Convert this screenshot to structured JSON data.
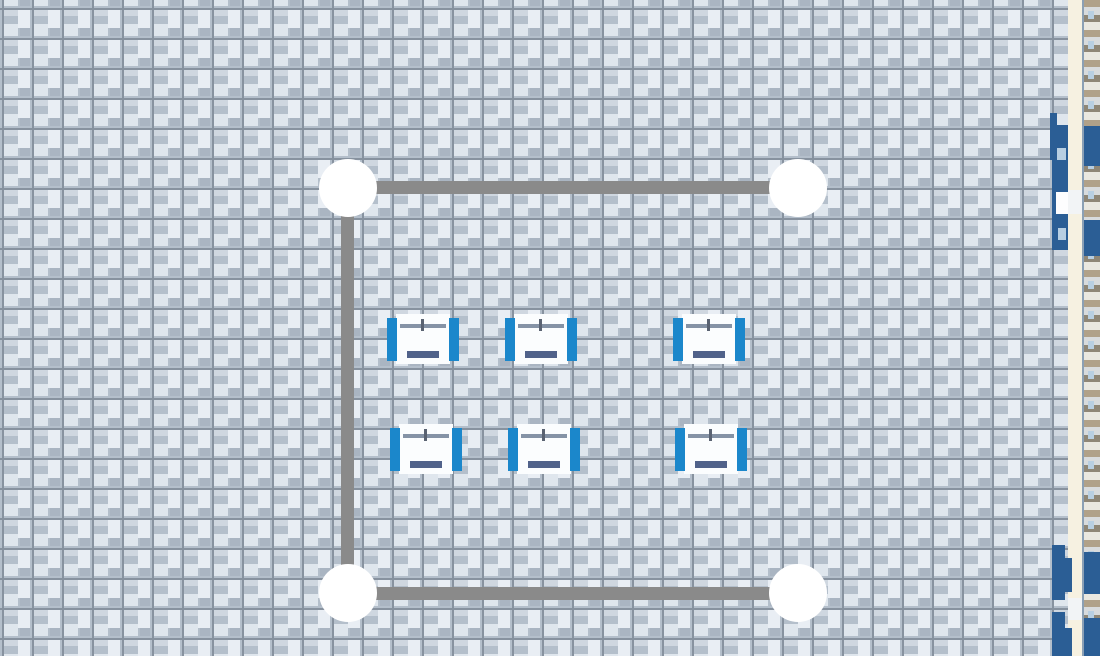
{
  "scene": {
    "width": 1100,
    "height": 656,
    "description": "top-down construction-game floor view with fence path, posts and gym benches"
  },
  "palette": {
    "paver_base": "#b4bfcb",
    "paver_light": "#e9eef4",
    "paver_soft": "#dfe6ed",
    "paver_mid": "#cfd7e0",
    "paver_dark": "#aab5c2",
    "grout": "#87929f",
    "path_gray": "#8a8a8a",
    "node_white": "#ffffff",
    "bench_blue": "#1b87cb",
    "bench_body": "#fbfdfe",
    "barbell_gray": "#8593a6",
    "barbell_dark": "#5a6372",
    "pad_slate": "#50628a",
    "steel_blue": "#2b5e95",
    "cream": "#f6f1e1",
    "edge_line": "#8ba0b5",
    "door_light": "#f2f4f6",
    "light_blue_sq": "#b8cfe2",
    "white": "#fdfdfe",
    "plank_tan": "#b0a189",
    "plank_silver": "#d8dbdd",
    "plank_brown": "#8f8777",
    "plank_white": "#eae8e0"
  },
  "floor": {
    "tile_size": 30,
    "offset_x": 2,
    "offset_y": 8
  },
  "path": {
    "thickness": 13,
    "segments": [
      {
        "x": 348,
        "y": 181,
        "w": 450,
        "h": 13
      },
      {
        "x": 341,
        "y": 188,
        "w": 13,
        "h": 405
      },
      {
        "x": 348,
        "y": 587,
        "w": 450,
        "h": 13
      }
    ],
    "node_radius": 29,
    "nodes": [
      {
        "cx": 348,
        "cy": 188
      },
      {
        "cx": 798,
        "cy": 188
      },
      {
        "cx": 348,
        "cy": 593
      },
      {
        "cx": 798,
        "cy": 593
      }
    ]
  },
  "equipment": {
    "type": "weight-bench",
    "count": 6,
    "width": 72,
    "height": 50,
    "items": [
      {
        "x": 387,
        "y": 314
      },
      {
        "x": 505,
        "y": 314
      },
      {
        "x": 673,
        "y": 314
      },
      {
        "x": 390,
        "y": 424
      },
      {
        "x": 508,
        "y": 424
      },
      {
        "x": 675,
        "y": 424
      }
    ]
  },
  "right_edge": {
    "cream_strip": {
      "x": 1068,
      "y": 0,
      "w": 14,
      "h": 656
    },
    "divider": {
      "x": 1082,
      "y": 0,
      "w": 2,
      "h": 656
    },
    "plank_strip": {
      "x": 1084,
      "y": 0,
      "w": 16,
      "h": 656
    },
    "blocks": [
      {
        "x": 1050,
        "y": 113,
        "w": 7,
        "h": 47,
        "c": "steel_blue"
      },
      {
        "x": 1052,
        "y": 125,
        "w": 16,
        "h": 125,
        "c": "steel_blue"
      },
      {
        "x": 1057,
        "y": 148,
        "w": 9,
        "h": 12,
        "c": "light_blue_sq"
      },
      {
        "x": 1056,
        "y": 192,
        "w": 12,
        "h": 22,
        "c": "white"
      },
      {
        "x": 1068,
        "y": 190,
        "w": 14,
        "h": 24,
        "c": "door_light"
      },
      {
        "x": 1058,
        "y": 228,
        "w": 8,
        "h": 12,
        "c": "light_blue_sq"
      },
      {
        "x": 1084,
        "y": 126,
        "w": 16,
        "h": 40,
        "c": "steel_blue"
      },
      {
        "x": 1084,
        "y": 220,
        "w": 16,
        "h": 36,
        "c": "steel_blue"
      },
      {
        "x": 1052,
        "y": 545,
        "w": 13,
        "h": 55,
        "c": "steel_blue"
      },
      {
        "x": 1052,
        "y": 612,
        "w": 13,
        "h": 44,
        "c": "steel_blue"
      },
      {
        "x": 1064,
        "y": 558,
        "w": 8,
        "h": 34,
        "c": "steel_blue"
      },
      {
        "x": 1064,
        "y": 628,
        "w": 8,
        "h": 28,
        "c": "steel_blue"
      },
      {
        "x": 1084,
        "y": 552,
        "w": 16,
        "h": 42,
        "c": "steel_blue"
      },
      {
        "x": 1084,
        "y": 618,
        "w": 16,
        "h": 38,
        "c": "steel_blue"
      },
      {
        "x": 1068,
        "y": 598,
        "w": 14,
        "h": 22,
        "c": "door_light"
      }
    ]
  }
}
